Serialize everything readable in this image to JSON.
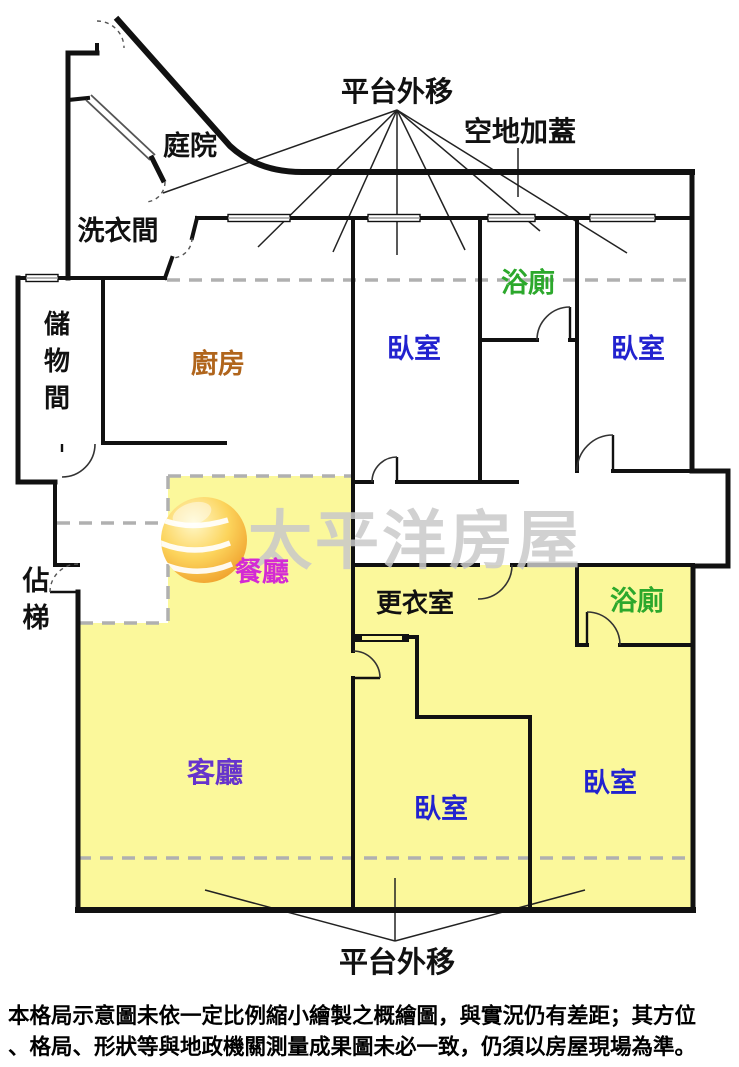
{
  "annotations": {
    "platform_top": "平台外移",
    "vacant_cover": "空地加蓋",
    "platform_bottom": "平台外移"
  },
  "rooms": {
    "courtyard": {
      "label": "庭院",
      "color": "#111111"
    },
    "laundry": {
      "label": "洗衣間",
      "color": "#111111"
    },
    "storage": {
      "chars": [
        "儲",
        "物",
        "間"
      ],
      "color": "#111111"
    },
    "kitchen": {
      "label": "廚房",
      "color": "#b0651c"
    },
    "bedroom_top_left": {
      "label": "臥室",
      "color": "#2222cf"
    },
    "bath_top": {
      "label": "浴廁",
      "color": "#2ca82c"
    },
    "bedroom_top_right": {
      "label": "臥室",
      "color": "#2222cf"
    },
    "dining": {
      "label": "餐廳",
      "color": "#d42ad4"
    },
    "stair": {
      "chars": [
        "佔",
        "梯"
      ],
      "color": "#111111"
    },
    "dressing": {
      "label": "更衣室",
      "color": "#111111"
    },
    "bath_bottom": {
      "label": "浴廁",
      "color": "#2ca82c"
    },
    "living": {
      "label": "客廳",
      "color": "#6633cc"
    },
    "bedroom_bottom_middle": {
      "label": "臥室",
      "color": "#2222cf"
    },
    "bedroom_bottom_right": {
      "label": "臥室",
      "color": "#2222cf"
    }
  },
  "watermark": {
    "text": "太平洋房屋",
    "color": "#c9c9c9"
  },
  "colors": {
    "area_highlight": "#fbf89b",
    "dashed_line": "#b0b0b0",
    "wall": "#111111"
  },
  "disclaimer": {
    "line1": "本格局示意圖未依一定比例縮小繪製之概繪圖，與實況仍有差距；其方位",
    "line2": "、格局、形狀等與地政機關測量成果圖未必一致，仍須以房屋現場為準。"
  }
}
